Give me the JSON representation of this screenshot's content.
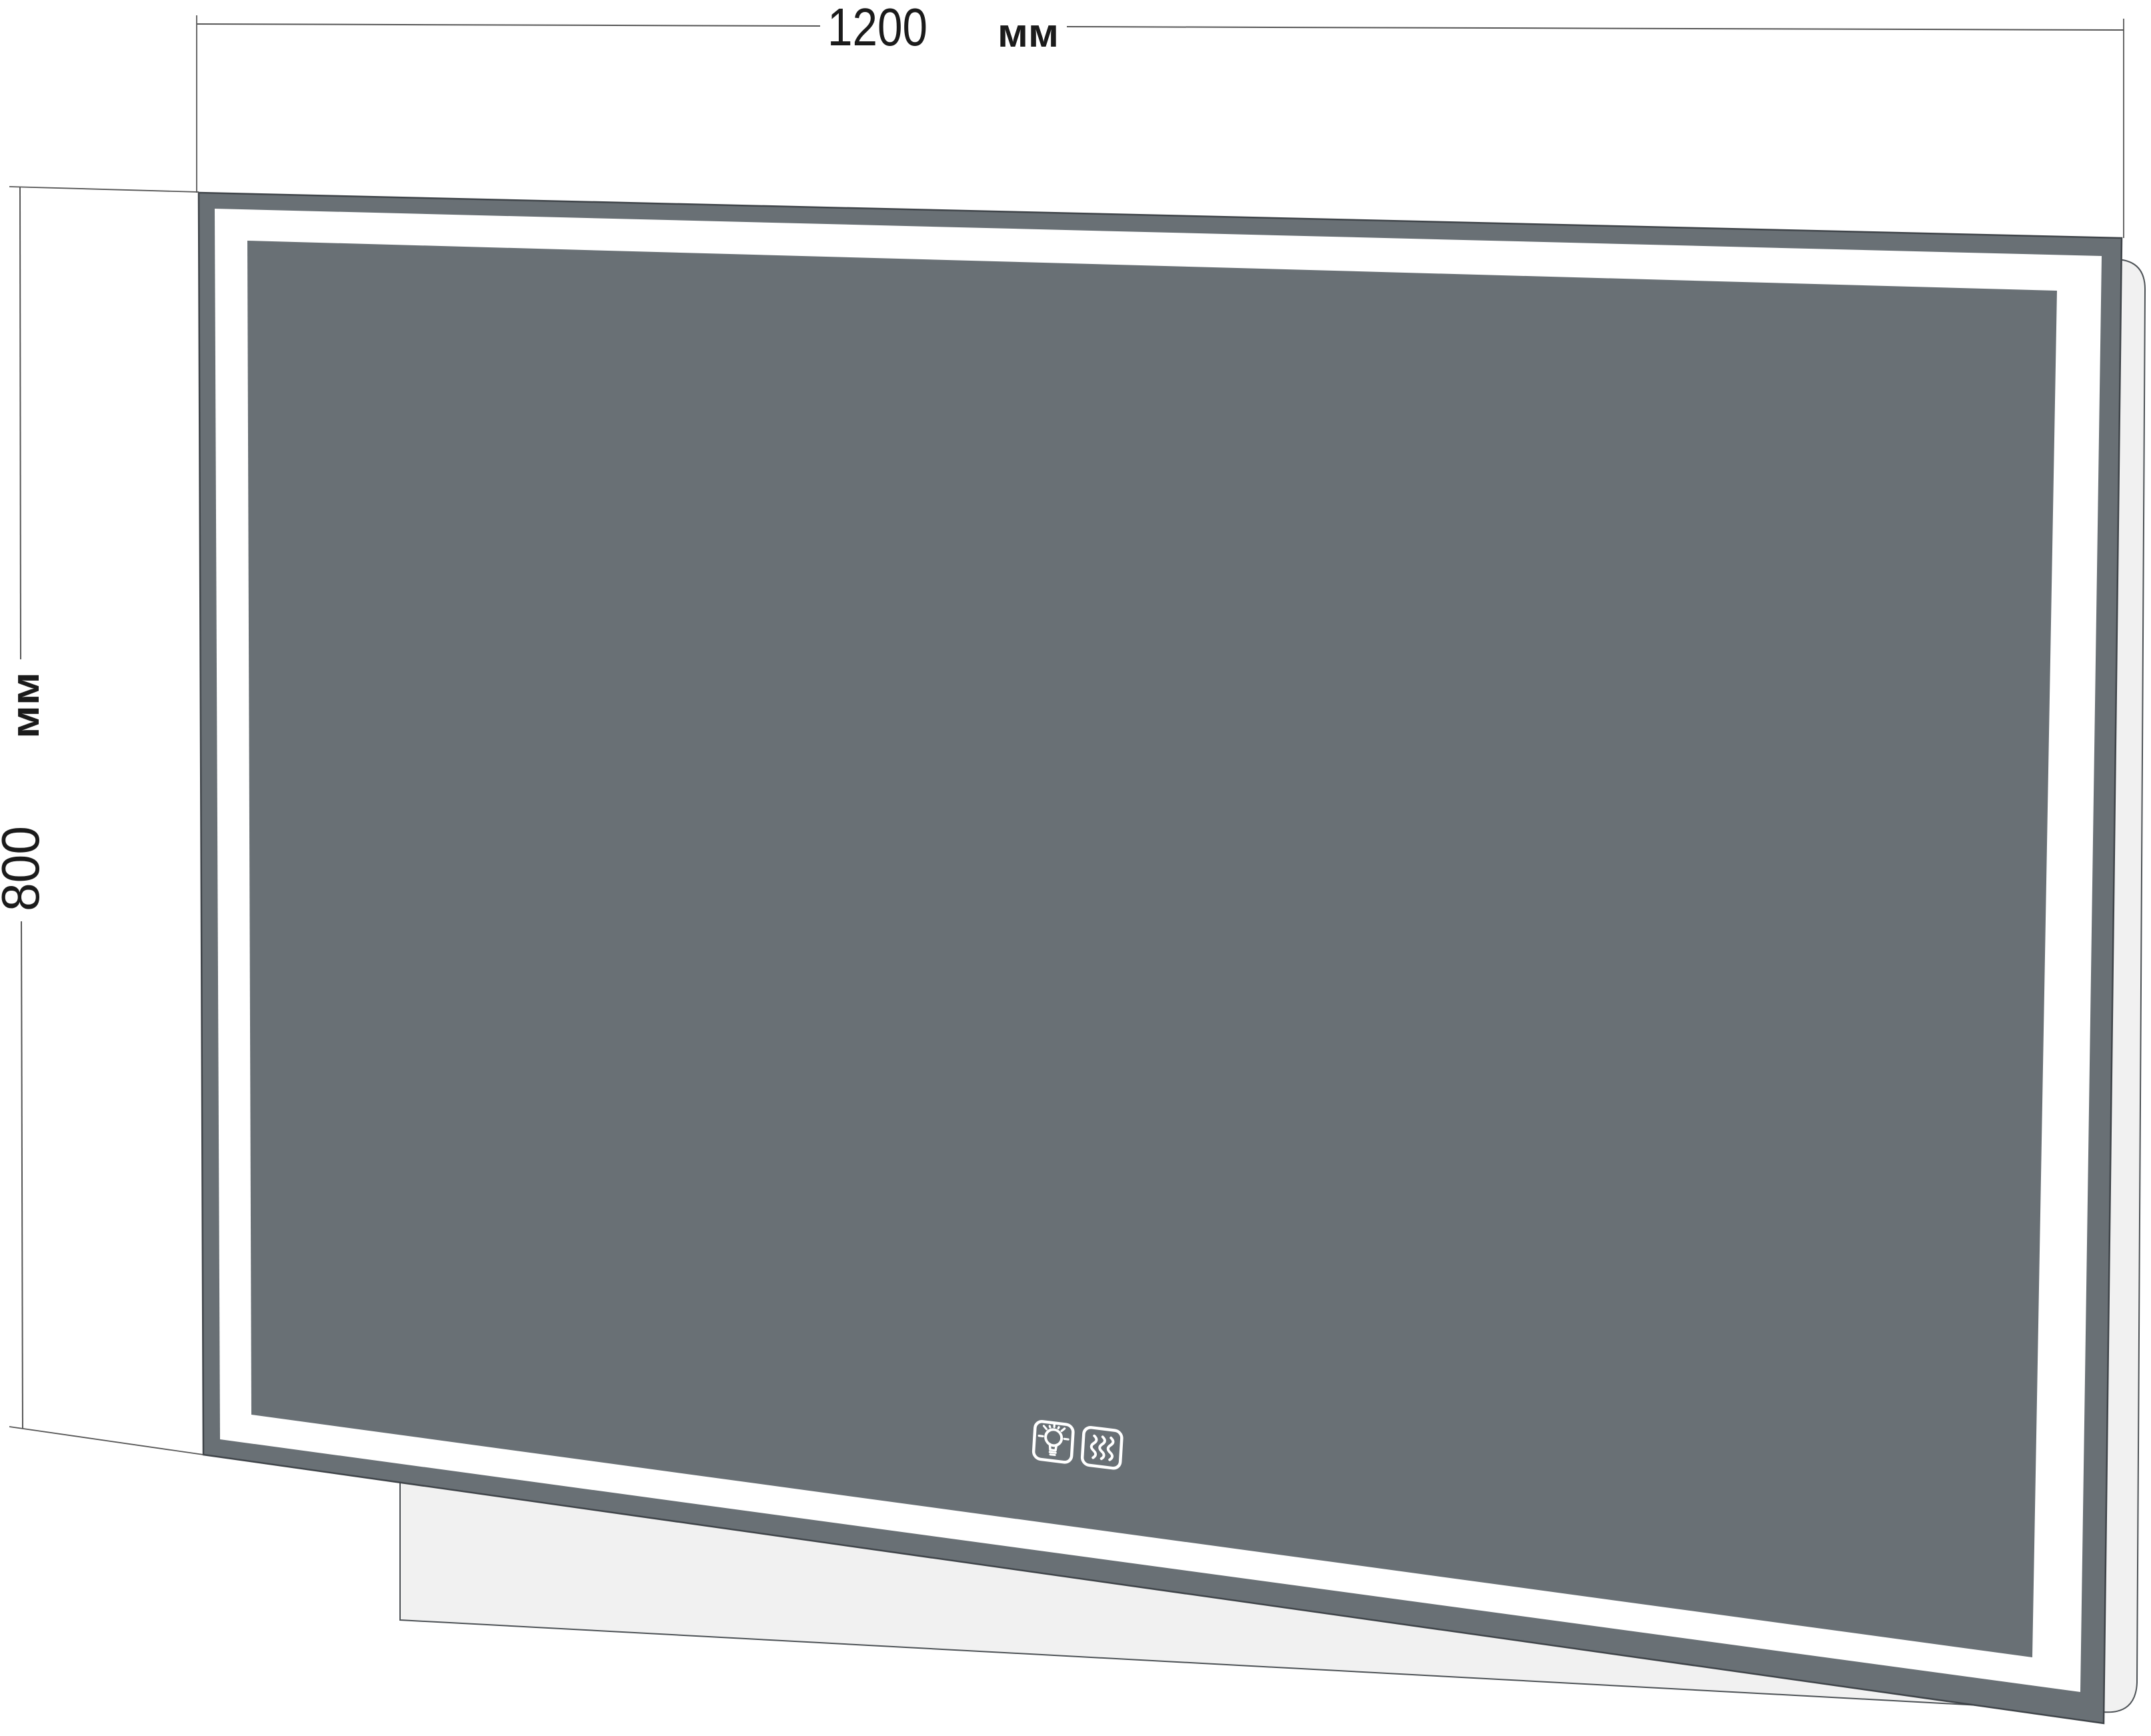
{
  "product_diagram": {
    "title": "LED bathroom mirror dimensional drawing",
    "width_dimension": {
      "value": "1200",
      "unit": "мм"
    },
    "height_dimension": {
      "value": "800",
      "unit": "мм"
    },
    "touch_controls": {
      "light_icon": "light-bulb-icon",
      "heating_icon": "heat-waves-icon"
    }
  },
  "colors": {
    "page_bg": "#ffffff",
    "mirror_gray": "#697075",
    "led_white": "#ffffff",
    "back_panel": "#f1f1f1",
    "panel_outline": "#4b5054",
    "frame_outline": "#3f4449",
    "dim_line": "#555555",
    "text_dark": "#1b1b1b",
    "icon_stroke": "#ffffff"
  }
}
